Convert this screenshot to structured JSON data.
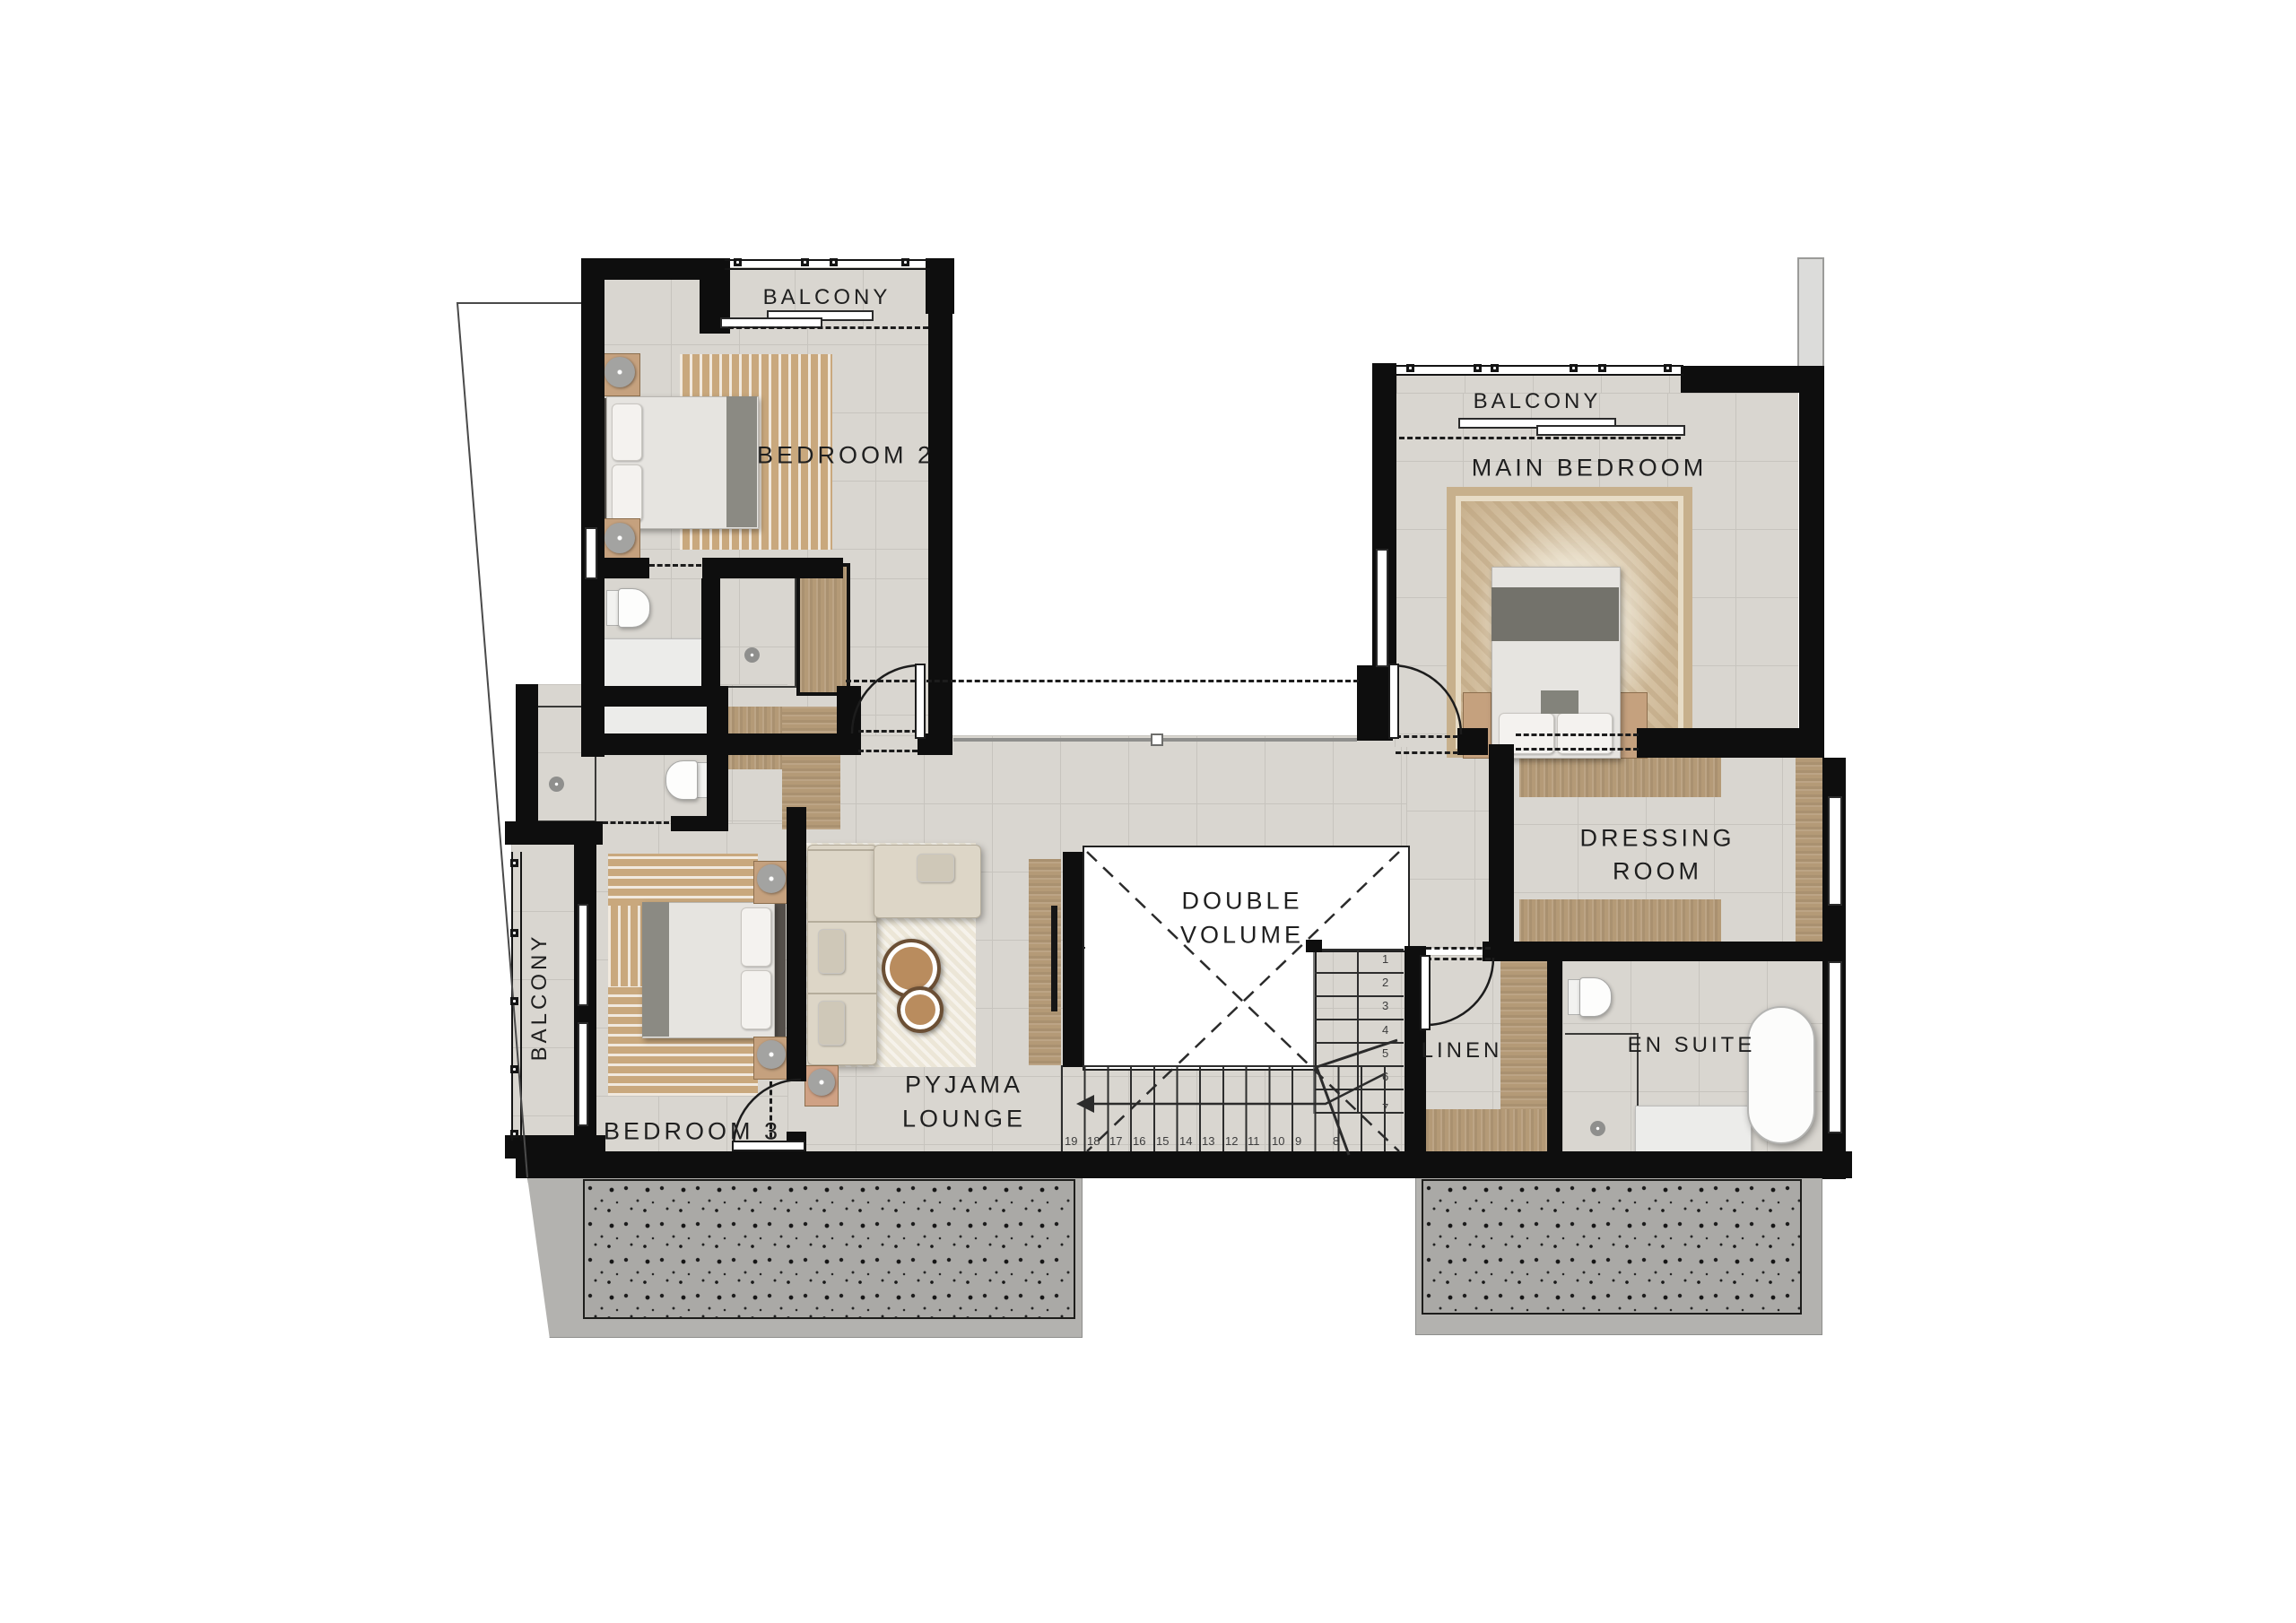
{
  "labels": {
    "balcony_bedroom2": "BALCONY",
    "bedroom2": "BEDROOM 2",
    "balcony_main": "BALCONY",
    "main_bedroom": "MAIN BEDROOM",
    "balcony_bedroom3": "BALCONY",
    "bedroom3": "BEDROOM 3",
    "pyjama_line1": "PYJAMA",
    "pyjama_line2": "LOUNGE",
    "double_line1": "DOUBLE",
    "double_line2": "VOLUME",
    "dressing_line1": "DRESSING",
    "dressing_line2": "ROOM",
    "linen": "LINEN",
    "en_suite": "EN SUITE"
  },
  "stairs": {
    "upper_run": [
      "1",
      "2",
      "3",
      "4",
      "5",
      "6",
      "7"
    ],
    "lower_run": [
      "19",
      "18",
      "17",
      "16",
      "15",
      "14",
      "13",
      "12",
      "11",
      "10",
      "9",
      "8"
    ]
  },
  "colors": {
    "wall": "#0e0e0e",
    "tile_floor": "#d9d6d0",
    "wood": "#b49a77",
    "rug_tan": "#c9a87d",
    "roof_speckle": "#aaa9a6",
    "text": "#1f1f1f",
    "white_void": "#ffffff"
  }
}
